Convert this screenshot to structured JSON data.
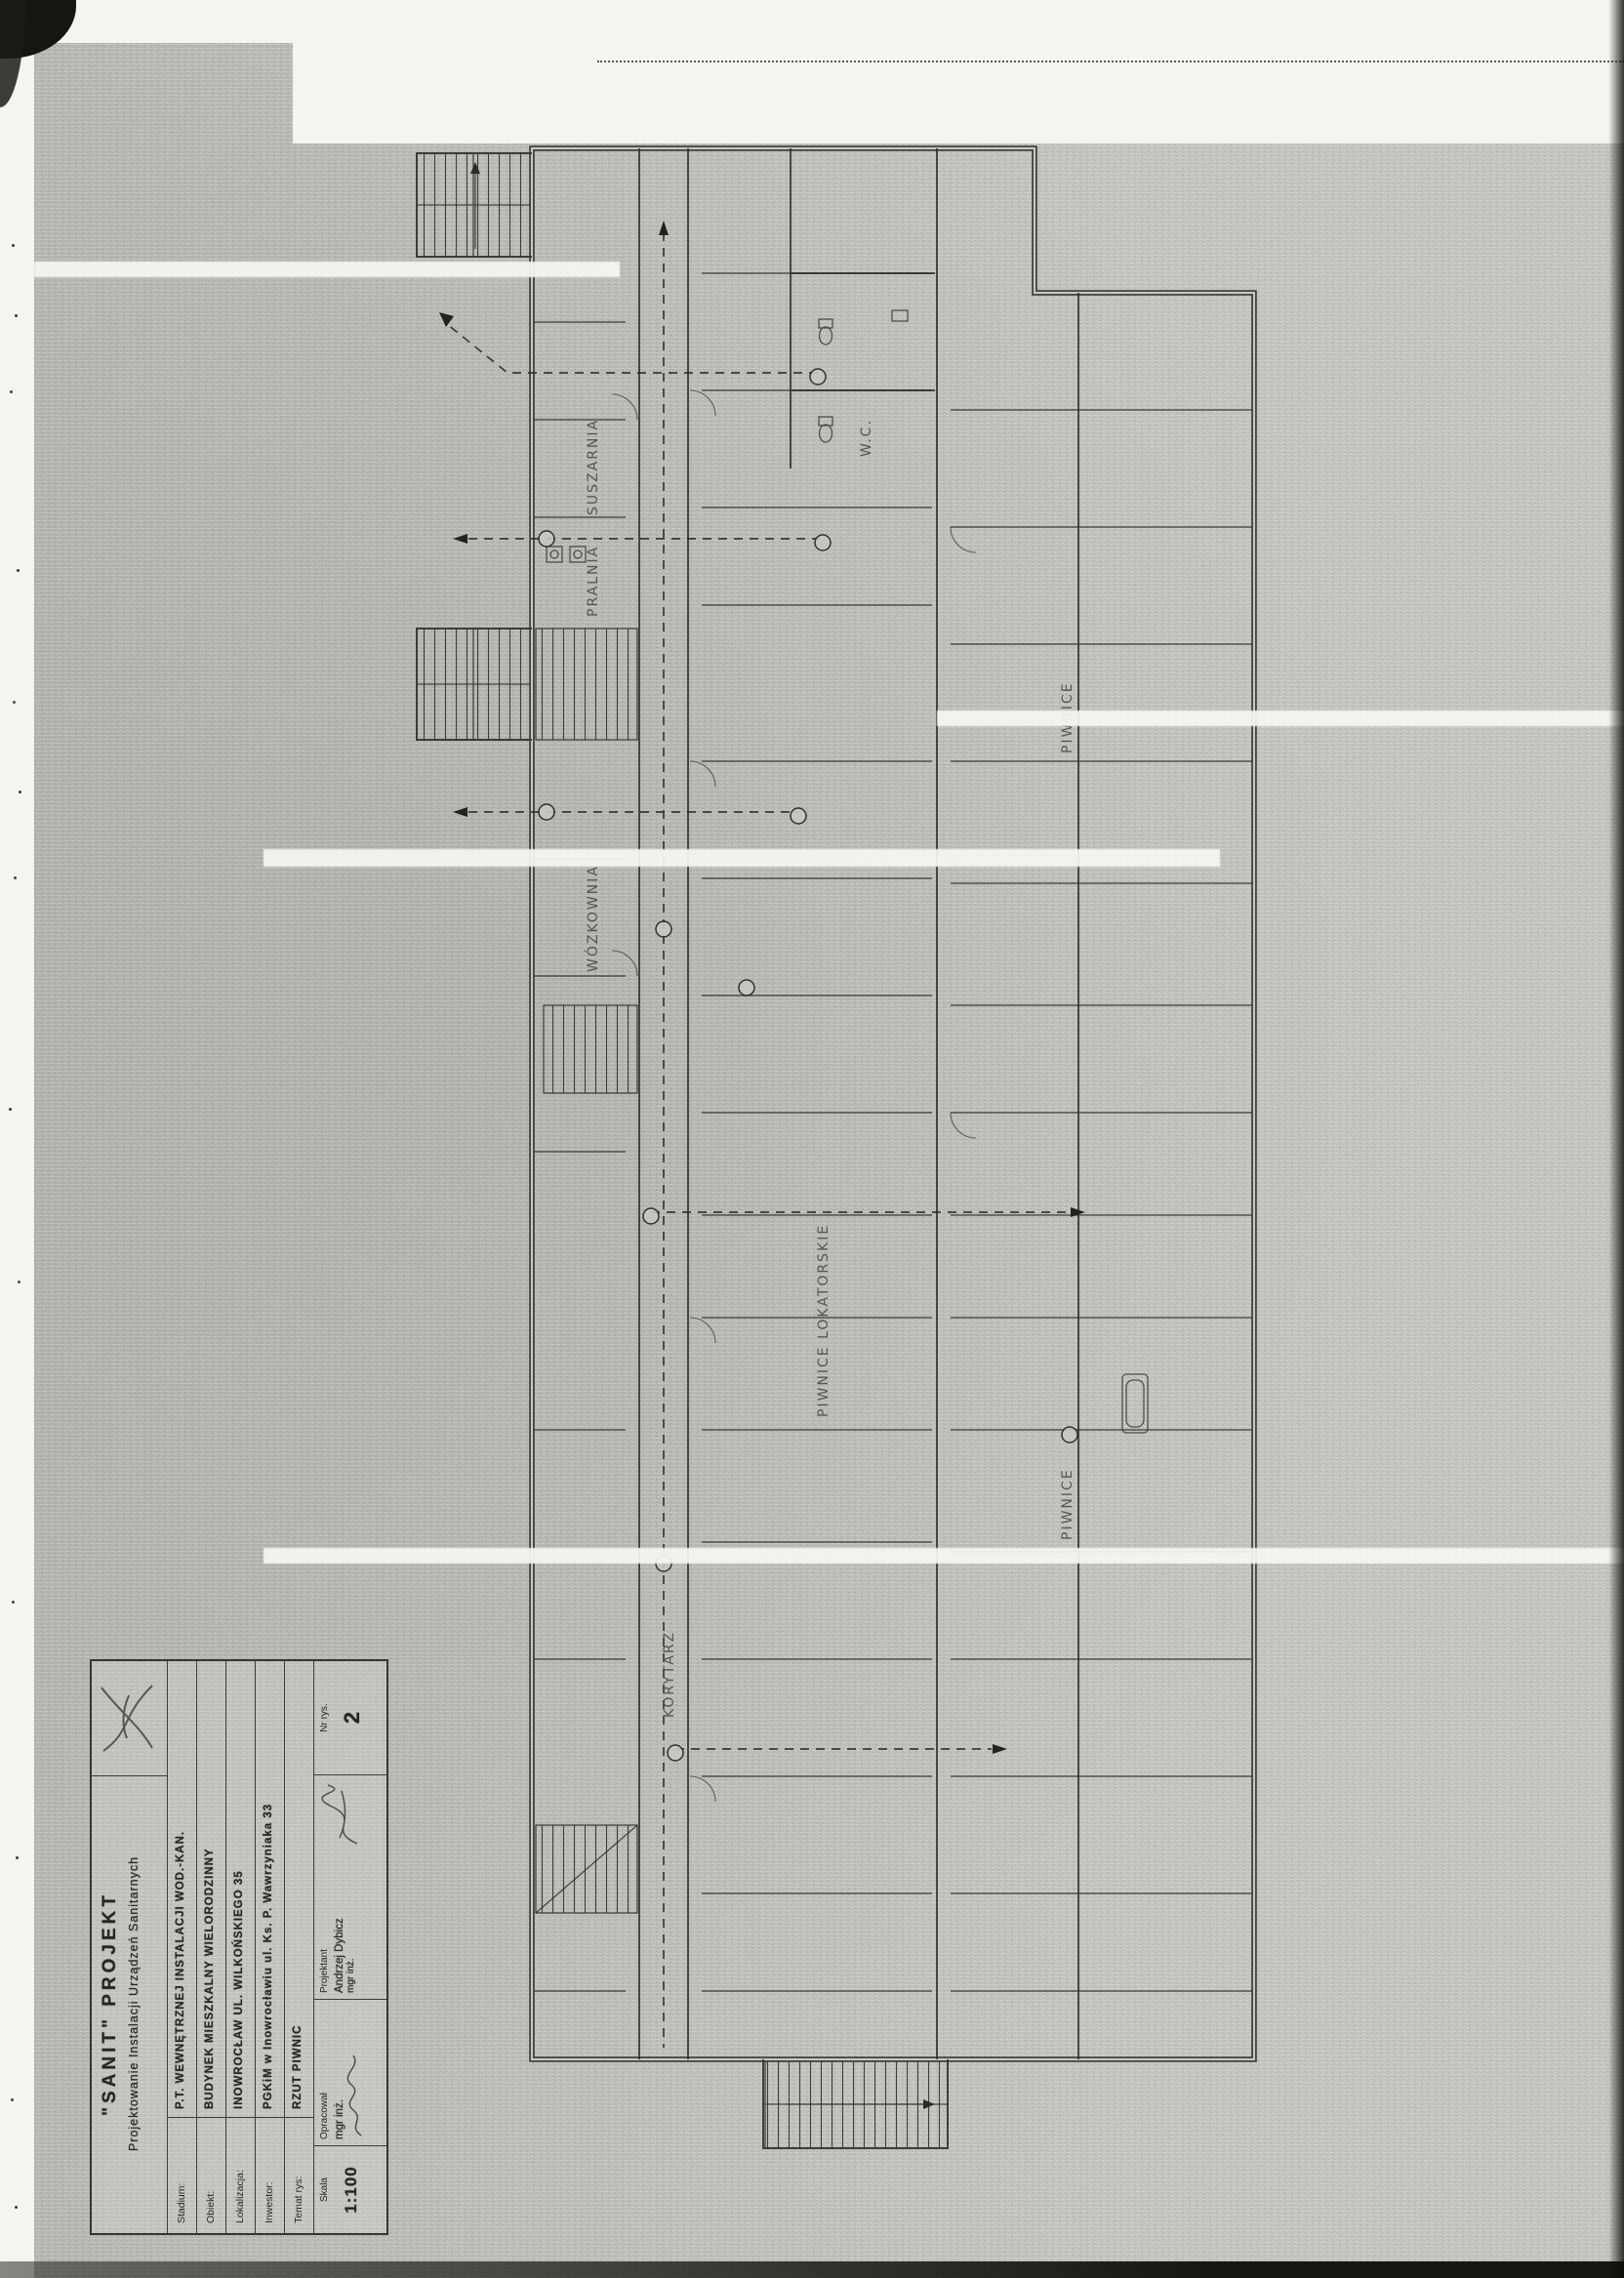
{
  "sheet": {
    "paper_color": "#c7c7c3",
    "ink_color": "#26261f"
  },
  "title_block": {
    "company": "\"SANIT\" PROJEKT",
    "company_subtitle": "Projektowanie Instalacji Urządzeń Sanitarnych",
    "rows": [
      {
        "label": "Stadium:",
        "value": "P.T. WEWNĘTRZNEJ INSTALACJI WOD.-KAN."
      },
      {
        "label": "Obiekt:",
        "value": "BUDYNEK MIESZKALNY WIELORODZINNY"
      },
      {
        "label": "Lokalizacja:",
        "value": "INOWROCŁAW UL. WILKOŃSKIEGO 35"
      },
      {
        "label": "Inwestor:",
        "value": "PGKiM w Inowrocławiu ul. Ks. P. Wawrzyniaka 33"
      },
      {
        "label": "Temat rys:",
        "value": "RZUT PIWNIC"
      }
    ],
    "skala": {
      "label": "Skala",
      "value": "1:100"
    },
    "opracowal": {
      "label": "Opracował",
      "name": "mgr inż."
    },
    "projektant": {
      "label": "Projektant",
      "name": "Andrzej Dybicz",
      "title": "mgr inż."
    },
    "nr_rys": {
      "label": "Nr rys.",
      "value": "2"
    }
  },
  "plan": {
    "room_labels": [
      {
        "text": "PRALNIA"
      },
      {
        "text": "SUSZARNIA"
      },
      {
        "text": "WÓZKOWNIA"
      },
      {
        "text": "W.C."
      },
      {
        "text": "PIWNICE LOKATORSKIE"
      },
      {
        "text": "KORYTARZ"
      },
      {
        "text": "PIWNICE"
      },
      {
        "text": "PIWNICE"
      }
    ]
  }
}
